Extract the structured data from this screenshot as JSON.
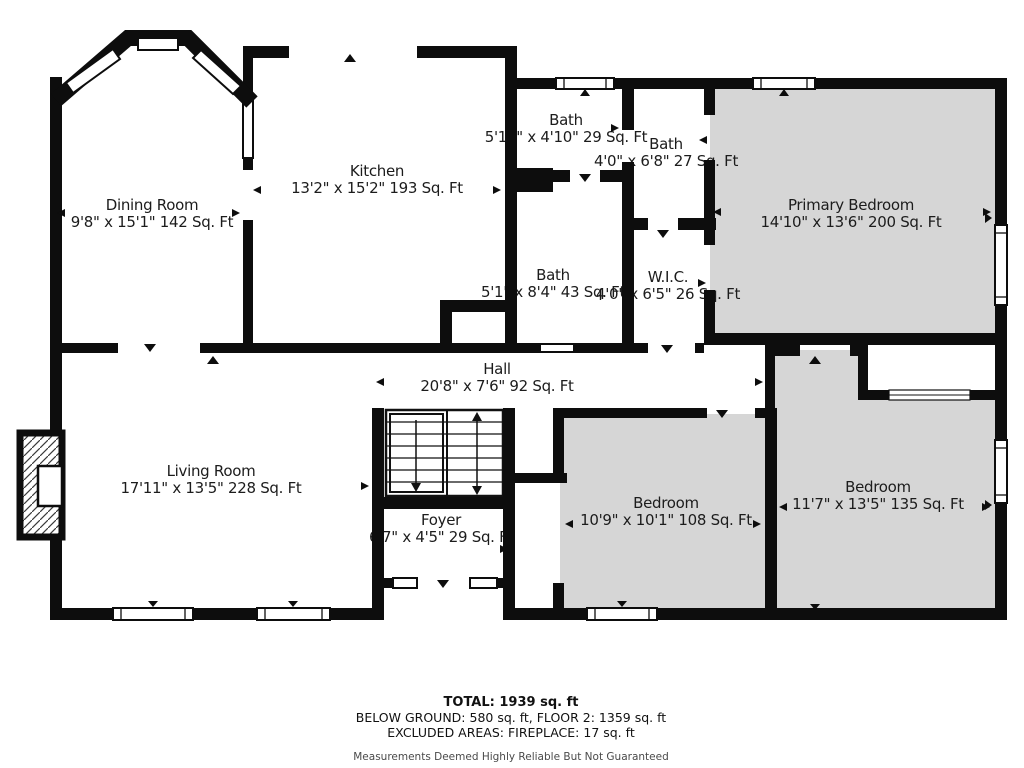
{
  "rooms": [
    {
      "name": "Dining Room",
      "dims": "9'8\" x 15'1\" 142 Sq. Ft"
    },
    {
      "name": "Kitchen",
      "dims": "13'2\" x 15'2\" 193 Sq. Ft"
    },
    {
      "name": "Bath",
      "dims": "5'11\" x 4'10\" 29 Sq. Ft"
    },
    {
      "name": "Bath",
      "dims": "4'0\" x 6'8\" 27 Sq. Ft"
    },
    {
      "name": "Primary Bedroom",
      "dims": "14'10\" x 13'6\" 200 Sq. Ft"
    },
    {
      "name": "Bath",
      "dims": "5'1\" x 8'4\" 43 Sq. Ft"
    },
    {
      "name": "W.I.C.",
      "dims": "4'0\" x 6'5\" 26 Sq. Ft"
    },
    {
      "name": "Hall",
      "dims": "20'8\" x 7'6\" 92 Sq. Ft"
    },
    {
      "name": "Living Room",
      "dims": "17'11\" x 13'5\" 228 Sq. Ft"
    },
    {
      "name": "Foyer",
      "dims": "6'7\" x 4'5\" 29 Sq. Ft"
    },
    {
      "name": "Bedroom",
      "dims": "10'9\" x 10'1\" 108 Sq. Ft"
    },
    {
      "name": "Bedroom",
      "dims": "11'7\" x 13'5\" 135 Sq. Ft"
    }
  ],
  "footer": {
    "total": "TOTAL: 1939 sq. ft",
    "breakdown": "BELOW GROUND: 580 sq. ft, FLOOR 2: 1359 sq. ft",
    "excluded": "EXCLUDED AREAS: FIREPLACE: 17 sq. ft",
    "disclaimer": "Measurements Deemed Highly Reliable But Not Guaranteed"
  },
  "colors": {
    "wall": "#0d0d0d",
    "room_fill_gray": "#d6d6d6",
    "text": "#1c1c1c"
  }
}
